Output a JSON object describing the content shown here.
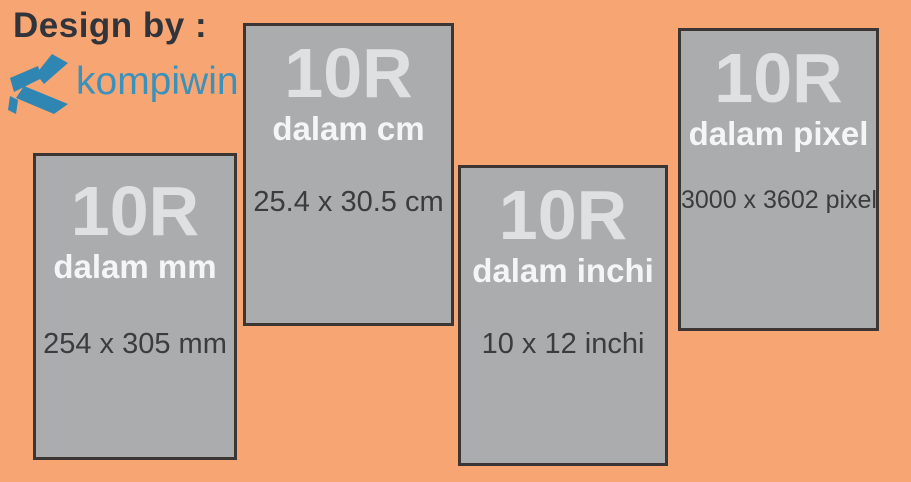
{
  "page": {
    "width": 911,
    "height": 482,
    "background_color": "#F7A573",
    "description": "Infographic of 10R photo print size in different units"
  },
  "header": {
    "credit_label": "Design by :",
    "brand_name": "kompiwin",
    "logo_icon": "kompiwin-k-logo",
    "brand_color": "#3A92BC",
    "logo_color": "#2F86B3",
    "credit_color": "#31343A"
  },
  "cards": [
    {
      "title": "10R",
      "subtitle": "dalam mm",
      "dimension": "254 x 305 mm"
    },
    {
      "title": "10R",
      "subtitle": "dalam cm",
      "dimension": "25.4 x 30.5 cm"
    },
    {
      "title": "10R",
      "subtitle": "dalam inchi",
      "dimension": "10 x 12 inchi"
    },
    {
      "title": "10R",
      "subtitle": "dalam pixel",
      "dimension": "3000 x 3602 pixel"
    }
  ],
  "colors": {
    "card_fill": "#AAACAE",
    "card_border": "#3B3634",
    "title_text": "#DFE0E2",
    "subtitle_text": "#F4F5F7",
    "dimension_text": "#3C3C3E"
  }
}
